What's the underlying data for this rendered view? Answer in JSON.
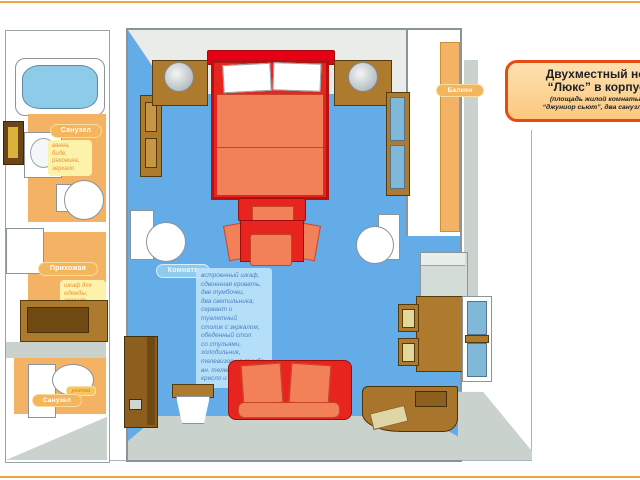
{
  "title_box": {
    "line1": "Двухместный ном",
    "line2": "“Люкс” в корпусе",
    "line3": "(площадь жилой комнаты 30",
    "line4": "“джуниор сьют”, два санузла, од"
  },
  "labels": {
    "bathroom_top": "Санузел",
    "hallway": "Прихожая",
    "bathroom_bottom": "Санузел",
    "toilet_tag": "унитаз",
    "room": "Комната",
    "balcony": "Балкон"
  },
  "notes": {
    "bathroom_top": "ванна,\nбиде,\nраковина,\nзеркало",
    "hallway": "шкаф для\nодежды,\nзеркало",
    "room": "встроенный шкаф,\nсдвоенная кровать,\nдве тумбочки,\nдва светильника,\nсервант и туалетный\nстолик с зеркалом,\nобеденный стол\nсо стульями,\nхолодильник,\nтелевизор на тумбе,\nвн. телефон,\nкресло и диван"
  },
  "colors": {
    "accent_orange": "#f2ae4e",
    "floor_blue": "#64ace8",
    "floor_orange": "#f3b264",
    "wall_gray": "#e9ece8",
    "furniture_red": "#e8241e",
    "cushion_salmon": "#f28058",
    "wood_brown": "#a9752c",
    "title_border": "#e84b10"
  }
}
